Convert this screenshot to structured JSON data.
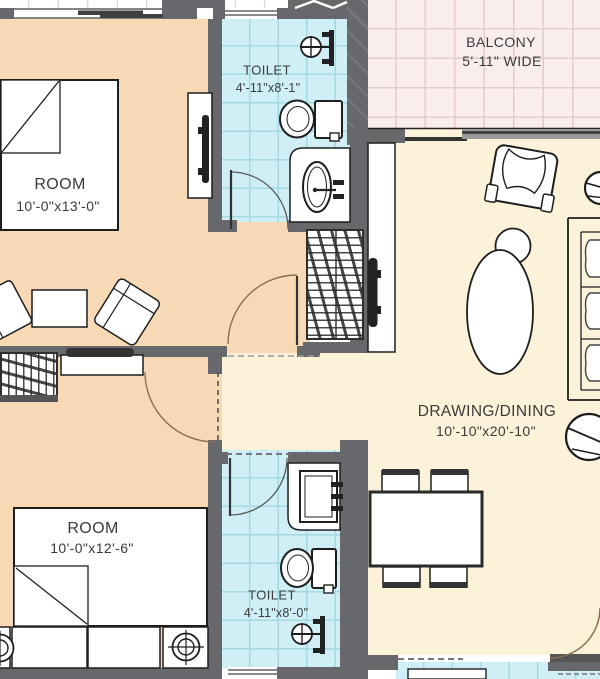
{
  "title": "2BHK apartment floor plan",
  "rooms": {
    "bedroom_top": {
      "label": "ROOM",
      "dims": "10'-0\"x13'-0\""
    },
    "toilet_top": {
      "label": "TOILET",
      "dims": "4'-11\"x8'-1\""
    },
    "balcony": {
      "label": "BALCONY",
      "dims": "5'-11\" WIDE"
    },
    "living": {
      "label": "DRAWING/DINING",
      "dims": "10'-10\"x20'-10\""
    },
    "bedroom_bottom": {
      "label": "ROOM",
      "dims": "10'-0\"x12'-6\""
    },
    "toilet_bottom": {
      "label": "TOILET",
      "dims": "4'-11\"x8'-0\""
    }
  },
  "colors": {
    "wall": "#67686b",
    "line": "#1e1e1e",
    "text": "#3b3b3b",
    "room_fill": "#f8d9b6",
    "toilet_fill": "#cfeef5",
    "toilet_grid": "#a4d9e2",
    "balcony_fill": "#f9eded",
    "balcony_grid": "#e6cbcb",
    "living_fill": "#fbf2d9",
    "door_arc": "#8a6f52"
  }
}
